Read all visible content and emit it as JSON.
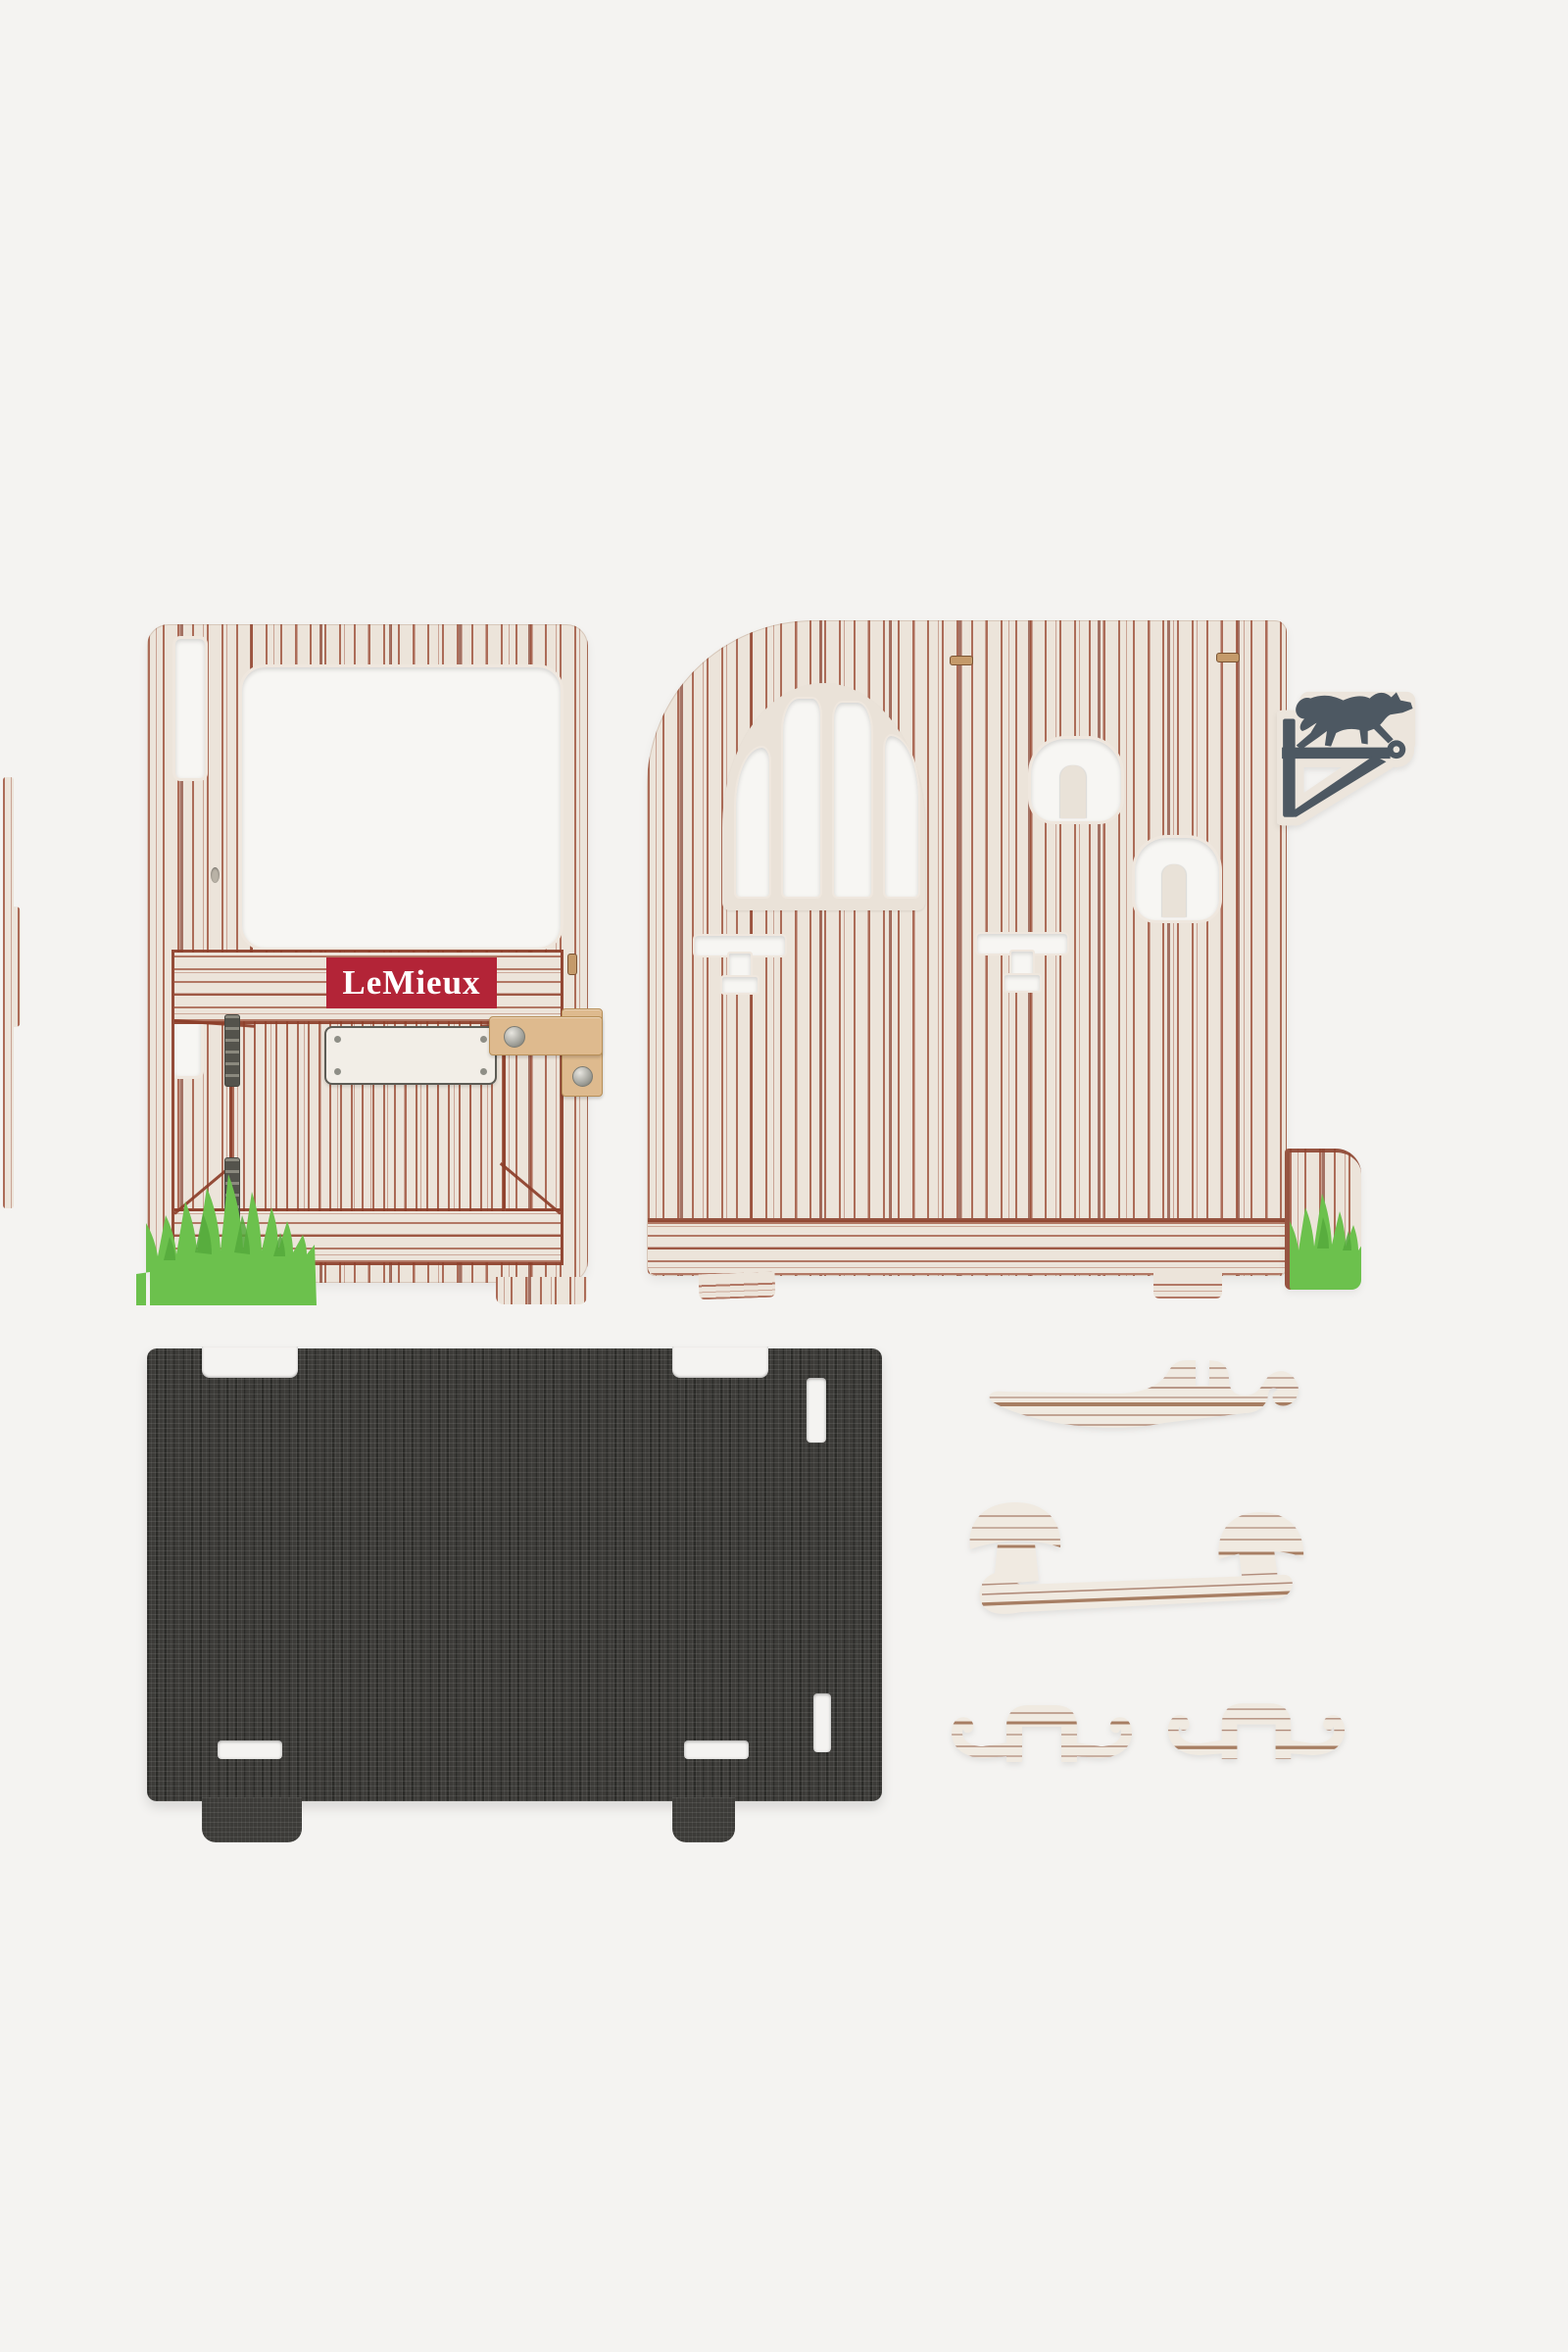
{
  "scene": {
    "type": "product-photo",
    "background": "#f4f3f1"
  },
  "brand_label": {
    "text": "LeMieux"
  },
  "colors": {
    "background": "#f4f3f1",
    "panel_cream": "#ece4da",
    "grain_brown": "#9a4a33",
    "label_red": "#b32437",
    "label_text": "#ffffff",
    "grass_green": "#6cc14d",
    "grass_green_dark": "#55a93c",
    "mat_charcoal": "#3c3b38",
    "latch_wood": "#deba8e",
    "weathervane_grey": "#4d5862",
    "accessory_grain": "#b18c7b"
  },
  "parts": {
    "door_panel": {
      "label": "stable-door-panel"
    },
    "side_panel": {
      "label": "stable-side-panel"
    },
    "weathervane": {
      "label": "horse-weathervane"
    },
    "base_mat": {
      "label": "textured-base-mat"
    },
    "saddle_rack": {
      "label": "saddle-rack"
    },
    "blanket_rail": {
      "label": "blanket-rail"
    },
    "hook_left": {
      "label": "double-hook"
    },
    "hook_right": {
      "label": "double-hook"
    },
    "edge_strip": {
      "label": "edge-strip"
    }
  }
}
